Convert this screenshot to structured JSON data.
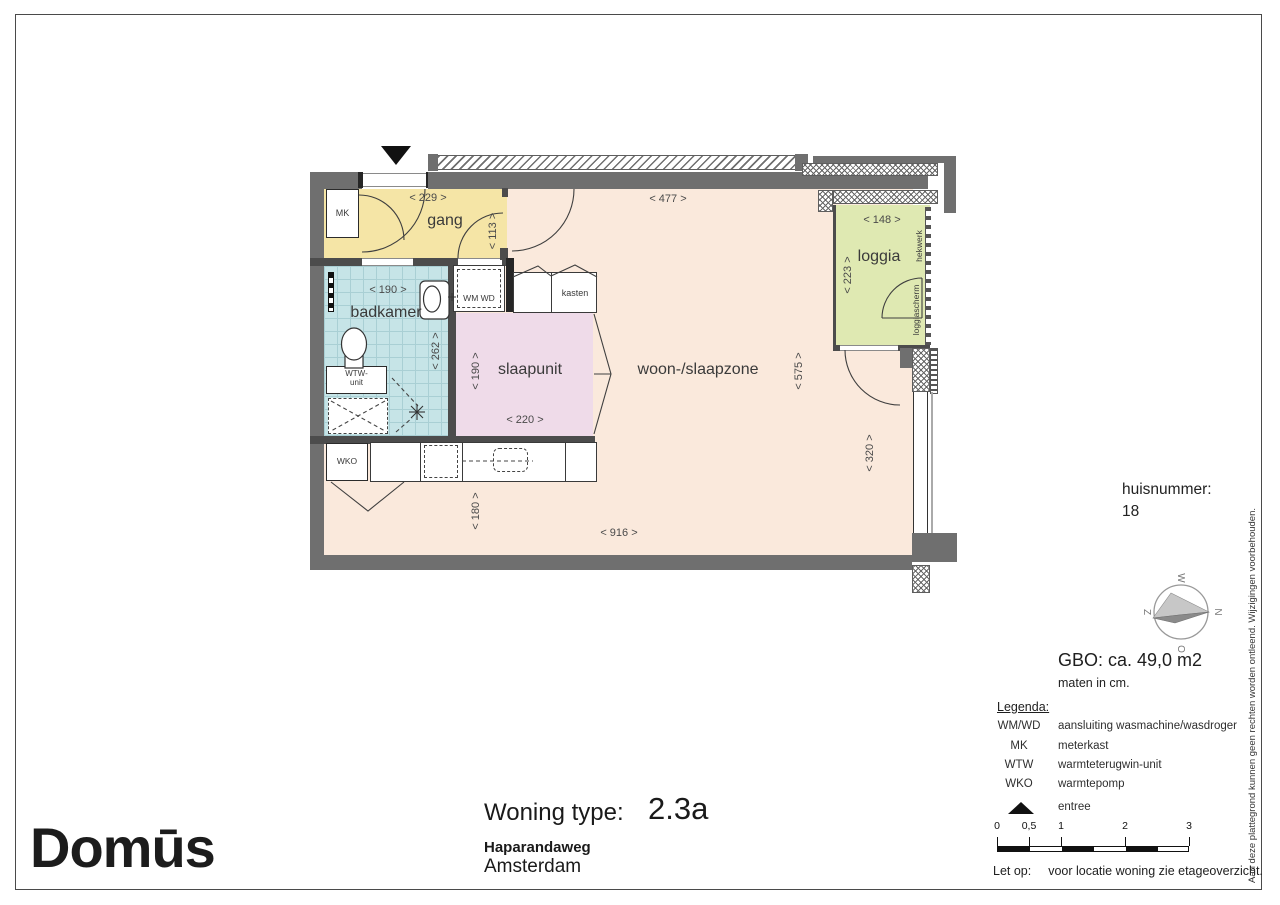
{
  "plan": {
    "rooms": {
      "gang": "gang",
      "badkamer": "badkamer",
      "slaapunit": "slaapunit",
      "woonzone": "woon-/slaapzone",
      "loggia": "loggia"
    },
    "fixtures": {
      "mk": "MK",
      "wmwd": "WM  WD",
      "wtw_line1": "WTW-",
      "wtw_line2": "unit",
      "wko": "WKO",
      "kasten": "kasten",
      "hekwerk": "hekwerk",
      "loggiascherm": "loggiascherm"
    },
    "dims": {
      "d229": "<  229  >",
      "d113": "<  113  >",
      "d477": "<  477  >",
      "d148": "<  148  >",
      "d223": "<  223  >",
      "d190b": "<  190  >",
      "d262": "<  262  >",
      "d190s": "<  190  >",
      "d220": "<  220  >",
      "d575": "<  575  >",
      "d320": "<  320  >",
      "d180": "<  180  >",
      "d916": "<  916  >"
    },
    "colors": {
      "wall": "#6f6f6f",
      "floor": "#fae9dc",
      "gang": "#f5e5a6",
      "badkamer": "#c6e4e7",
      "slaapunit": "#efdbe9",
      "loggia": "#dfe9b2"
    }
  },
  "sidebar": {
    "huisnummer_label": "huisnummer:",
    "huisnummer_value": "18",
    "compass": {
      "n": "N",
      "o": "O",
      "z": "Z",
      "w": "W"
    },
    "gbo": "GBO: ca. 49,0 m2",
    "maten": "maten in cm.",
    "legend": {
      "title": "Legenda:",
      "rows": [
        {
          "key": "WM/WD",
          "desc": "aansluiting wasmachine/wasdroger"
        },
        {
          "key": "MK",
          "desc": "meterkast"
        },
        {
          "key": "WTW",
          "desc": "warmteterugwin-unit"
        },
        {
          "key": "WKO",
          "desc": "warmtepomp"
        }
      ],
      "entree": "entree"
    },
    "scalebar": {
      "t0": "0",
      "t05": "0,5",
      "t1": "1",
      "t2": "2",
      "t3": "3"
    },
    "note_label": "Let op:",
    "note_text": "voor locatie woning zie etageoverzicht.",
    "disclaimer": "Aan deze plattegrond kunnen geen rechten worden ontleend. Wijzigingen voorbehouden."
  },
  "titleblock": {
    "type_label": "Woning type:",
    "type_value": "2.3a",
    "street": "Haparandaweg",
    "city": "Amsterdam",
    "logo": "Domūs"
  }
}
